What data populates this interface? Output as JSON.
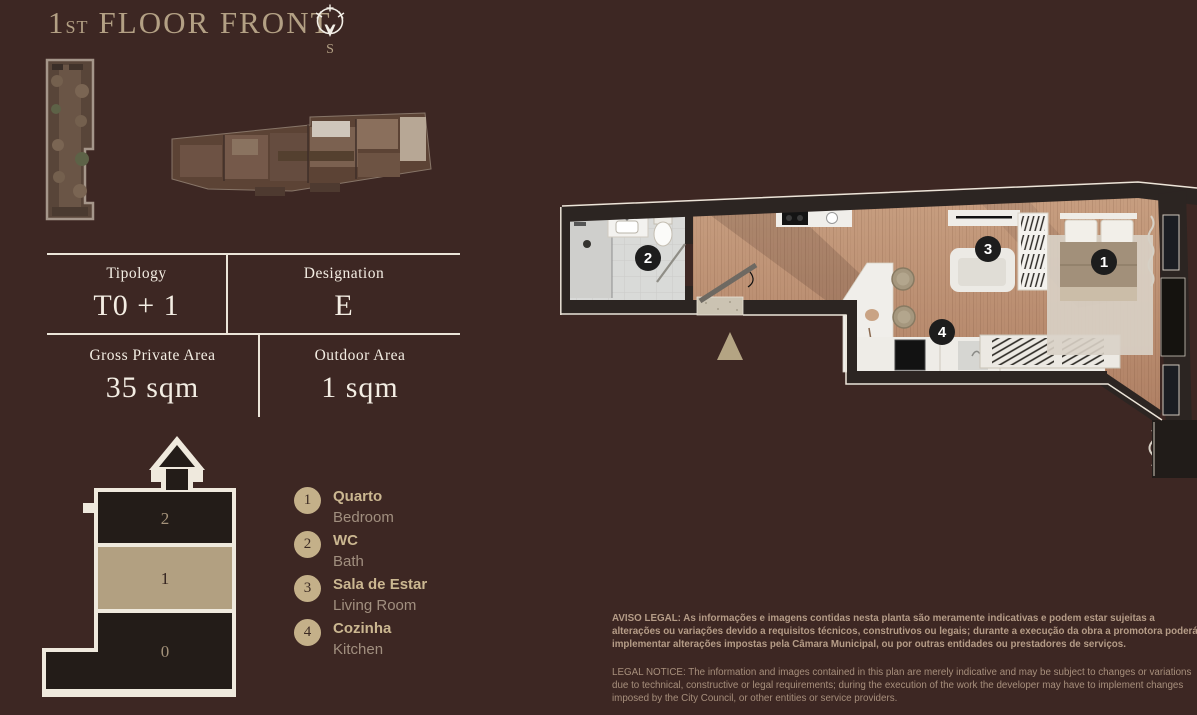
{
  "page": {
    "background_color": "#3d2723",
    "accent_tan": "#b3a084",
    "table_line_color": "#ece5d9",
    "legend_circle_color": "#c4b089",
    "plan_marker_color": "#1d1d1d",
    "highlight_floor_color": "#b2a081"
  },
  "header": {
    "title_number": "1",
    "title_ordinal": "ST",
    "title_text": "FLOOR FRONT",
    "compass_icon": "compass-south-icon",
    "compass_label": "S"
  },
  "spec_table": {
    "cells": [
      {
        "label": "Tipology",
        "value": "T0 + 1"
      },
      {
        "label": "Designation",
        "value": "E"
      },
      {
        "label": "Gross Private Area",
        "value": "35 sqm"
      },
      {
        "label": "Outdoor Area",
        "value": "1 sqm"
      }
    ]
  },
  "section": {
    "floors": [
      {
        "label": "2",
        "highlighted": false
      },
      {
        "label": "1",
        "highlighted": true
      },
      {
        "label": "0",
        "highlighted": false
      }
    ]
  },
  "legend": {
    "items": [
      {
        "number": "1",
        "pt": "Quarto",
        "en": "Bedroom"
      },
      {
        "number": "2",
        "pt": "WC",
        "en": "Bath"
      },
      {
        "number": "3",
        "pt": "Sala de Estar",
        "en": "Living Room"
      },
      {
        "number": "4",
        "pt": "Cozinha",
        "en": "Kitchen"
      }
    ]
  },
  "plan": {
    "markers": [
      {
        "number": "1",
        "room": "bedroom"
      },
      {
        "number": "2",
        "room": "bath"
      },
      {
        "number": "3",
        "room": "living-room"
      },
      {
        "number": "4",
        "room": "kitchen"
      }
    ]
  },
  "legal": {
    "pt": "AVISO LEGAL: As informações e imagens contidas nesta planta são meramente indicativas e podem estar sujeitas a alterações ou variações devido a requisitos técnicos, construtivos ou legais; durante a execução da obra a promotora poderá implementar alterações impostas pela Câmara Municipal, ou por outras entidades ou prestadores de serviços.",
    "en": "LEGAL NOTICE: The information and images contained in this plan are merely indicative and may be subject to changes or variations due to technical, constructive or legal requirements; during the execution of the work the developer may have to implement changes imposed by the City Council, or other entities or service providers."
  }
}
